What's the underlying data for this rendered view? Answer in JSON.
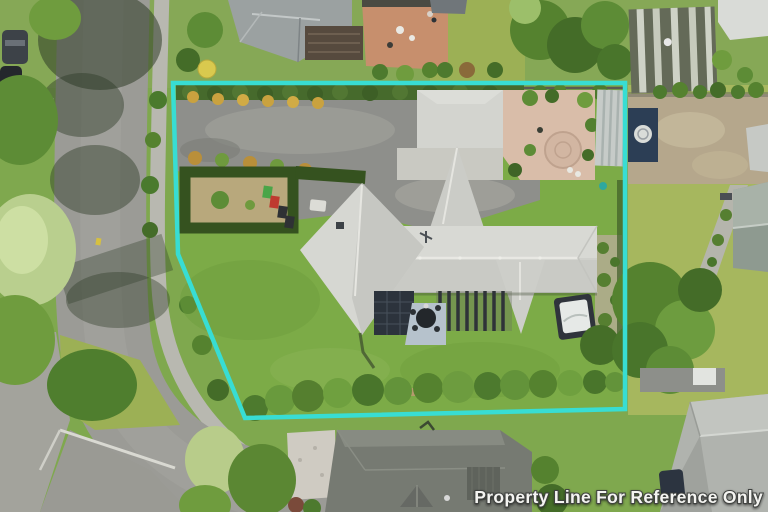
{
  "watermark": {
    "text": "Property Line For Reference Only",
    "color": "#f4f4f1",
    "outline_color": "#3f423f"
  },
  "boundary": {
    "points": "173,83 625,83 625,409 245,418 178,254",
    "color": "#38ddd3",
    "stroke_width": "4.5"
  },
  "palette": {
    "lawn_inside": "#7cab47",
    "lawn_neighbor": "#a6b75e",
    "road_asphalt": "#9b9b96",
    "footpath": "#b8b8b0",
    "driveway": "#8e8f8b",
    "main_roof": "#d4d5d0",
    "dark_roof": "#767a72",
    "terracotta_patio": "#c78f6d",
    "hedge_dark": "#466a2c",
    "spa_white": "#e6e9e7",
    "solar_panel": "#2c333c"
  }
}
